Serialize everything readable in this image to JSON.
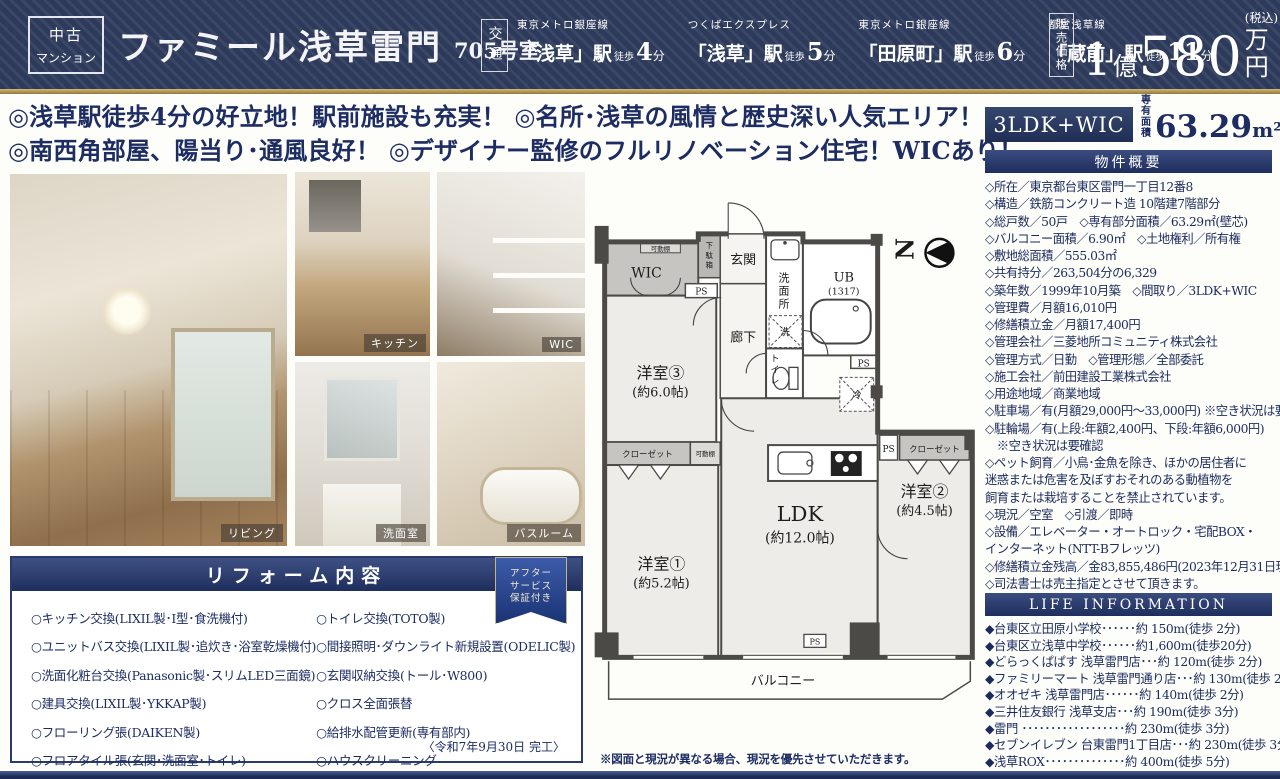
{
  "header": {
    "badge_line1": "中古",
    "badge_line2": "マンション",
    "title": "ファミール浅草雷門",
    "room_no": "705号室",
    "access_label": "交通",
    "stations": [
      {
        "line": "東京メトロ銀座線",
        "name": "「浅草」駅",
        "walk": "徒歩",
        "min": "4",
        "unit": "分"
      },
      {
        "line": "つくばエクスプレス",
        "name": "「浅草」駅",
        "walk": "徒歩",
        "min": "5",
        "unit": "分"
      },
      {
        "line": "東京メトロ銀座線",
        "name": "「田原町」駅",
        "walk": "徒歩",
        "min": "6",
        "unit": "分"
      },
      {
        "line": "都営浅草線",
        "name": "「蔵前」駅",
        "walk": "徒歩",
        "min": "11",
        "unit": "分"
      }
    ],
    "price_label": "販売価格",
    "price": {
      "num1": "1",
      "unit1": "億",
      "num2": "580",
      "unit2": "万円",
      "tax": "(税込)"
    }
  },
  "catch": {
    "line1": "◎浅草駅徒歩4分の好立地！駅前施設も充実！ ◎名所･浅草の風情と歴史深い人気エリア！",
    "line2": "◎南西角部屋、陽当り･通風良好！ ◎デザイナー監修のフルリノベーション住宅！WICあり！"
  },
  "photos": {
    "living": "リビング",
    "kitchen": "キッチン",
    "wic": "WIC",
    "washroom": "洗面室",
    "bathroom": "バスルーム"
  },
  "reform": {
    "title": "リフォーム内容",
    "ribbon_line1": "アフター",
    "ribbon_line2": "サービス",
    "ribbon_line3": "保証付き",
    "left_items": [
      "○キッチン交換(LIXIL製･I型･食洗機付)",
      "○ユニットバス交換(LIXIL製･追炊き･浴室乾燥機付)",
      "○洗面化粧台交換(Panasonic製･スリムLED三面鏡)",
      "○建具交換(LIXIL製･YKKAP製)",
      "○フローリング張(DAIKEN製)",
      "○フロアタイル張(玄関･洗面室･トイレ)"
    ],
    "right_items": [
      "○トイレ交換(TOTO製)",
      "○間接照明･ダウンライト新規設置(ODELIC製)",
      "○玄関収納交換(トール･W800)",
      "○クロス全面張替",
      "○給排水配管更新(専有部内)",
      "○ハウスクリーニング"
    ],
    "completion": "〈令和7年9月30日 完工〉"
  },
  "floorplan": {
    "north": "N",
    "labels": {
      "kadoudana1": "可動棚",
      "wic": "WIC",
      "getabako": [
        "下",
        "駄",
        "箱"
      ],
      "genkan": "玄関",
      "ps1": "PS",
      "senmenjo": [
        "洗",
        "面",
        "所"
      ],
      "washer": "洗",
      "ub1": "UB",
      "ub2": "(1317)",
      "rouka": "廊下",
      "toilet": [
        "ト",
        "イ",
        "レ"
      ],
      "ps2": "PS",
      "fridge": "冷",
      "room3a": "洋室③",
      "room3b": "(約6.0帖)",
      "closet1": "クローゼット",
      "kadoudana2": "可動棚",
      "room1a": "洋室①",
      "room1b": "(約5.2帖)",
      "ldka": "LDK",
      "ldkb": "(約12.0帖)",
      "ps3": "PS",
      "closet2": "クローゼット",
      "room2a": "洋室②",
      "room2b": "(約4.5帖)",
      "ps4": "PS",
      "balcony": "バルコニー"
    },
    "disclaimer": "※図面と現況が異なる場合、現況を優先させていただきます。"
  },
  "sidebar": {
    "layout": "3LDK+WIC",
    "area_label1": "専有",
    "area_label2": "面積",
    "area_value": "63.29",
    "area_unit": "m²",
    "area_note": "(壁芯)",
    "overview_title": "物件概要",
    "overview_lines": [
      "◇所在／東京都台東区雷門一丁目12番8",
      "◇構造／鉄筋コンクリート造 10階建7階部分",
      "◇総戸数／50戸　◇専有部分面積／63.29㎡(壁芯)",
      "◇バルコニー面積／6.90㎡　◇土地権利／所有権",
      "◇敷地総面積／555.03㎡",
      "◇共有持分／263,504分の6,329",
      "◇築年数／1999年10月築　◇間取り／3LDK+WIC",
      "◇管理費／月額16,010円",
      "◇修繕積立金／月額17,400円",
      "◇管理会社／三菱地所コミュニティ株式会社",
      "◇管理方式／日勤　◇管理形態／全部委託",
      "◇施工会社／前田建設工業株式会社",
      "◇用途地域／商業地域",
      "◇駐車場／有(月額29,000円～33,000円) ※空き状況は要確認",
      "◇駐輪場／有(上段:年額2,400円、下段:年額6,000円)",
      "　※空き状況は要確認",
      "◇ペット飼育／小鳥･金魚を除き、ほかの居住者に",
      "迷惑または危害を及ぼすおそれのある動植物を",
      "飼育または栽培することを禁止されています。",
      "◇現況／空室　◇引渡／即時",
      "◇設備／エレベーター・オートロック・宅配BOX・",
      "インターネット(NTT-Bフレッツ)",
      "◇修繕積立金残高／金83,855,486円(2023年12月31日現在)",
      "◇司法書士は売主指定とさせて頂きます。"
    ],
    "life_title": "LIFE INFORMATION",
    "life_lines": [
      "◆台東区立田原小学校･･････約 150m(徒歩 2分)",
      "◆台東区立浅草中学校･･････約1,600m(徒歩20分)",
      "◆どらっくぱぱす 浅草雷門店･･･約 120m(徒歩 2分)",
      "◆ファミリーマート 浅草雷門通り店･･･約 130m(徒歩 2分)",
      "◆オオゼキ 浅草雷門店･･････約 140m(徒歩 2分)",
      "◆三井住友銀行 浅草支店･･･約 190m(徒歩 3分)",
      "◆雷門 ･･････････････････約 230m(徒歩 3分)",
      "◆セブンイレブン 台東雷門1丁目店･･･約 230m(徒歩 3分)",
      "◆浅草ROX･･････････････約 400m(徒歩 5分)"
    ]
  }
}
